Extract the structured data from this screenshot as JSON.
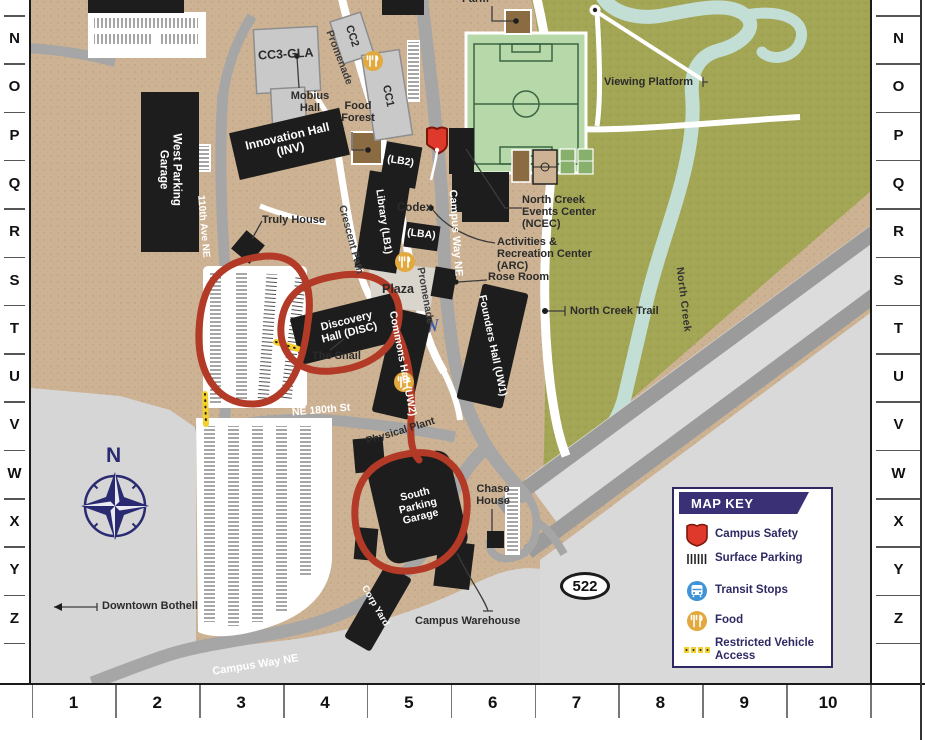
{
  "grid": {
    "rows": [
      "M",
      "N",
      "O",
      "P",
      "Q",
      "R",
      "S",
      "T",
      "U",
      "V",
      "W",
      "X",
      "Y",
      "Z"
    ],
    "cols": [
      "1",
      "2",
      "3",
      "4",
      "5",
      "6",
      "7",
      "8",
      "9",
      "10"
    ]
  },
  "buildings": {
    "west_parking_garage": "West Parking Garage",
    "innovation_hall": "Innovation Hall (INV)",
    "cc3_gla": "CC3-GLA",
    "mobius_hall": "Mobius Hall",
    "cc2": "CC2",
    "cc1": "CC1",
    "lb2": "(LB2)",
    "library": "Library (LB1)",
    "lba": "(LBA)",
    "codex": "Codex",
    "truly_house": "Truly House",
    "discovery_hall": "Discovery Hall (DISC)",
    "the_snail": "The Snail",
    "commons_hall": "Commons Hall (UW2)",
    "founders_hall": "Founders Hall (UW1)",
    "plaza": "Plaza",
    "rose_room": "Rose Room",
    "ncec": "North Creek Events Center (NCEC)",
    "arc": "Activities & Recreation Center (ARC)",
    "south_parking_garage": "South Parking Garage",
    "physical_plant": "Physical Plant",
    "chase_house": "Chase House",
    "corp_yard": "Corp Yard",
    "campus_warehouse": "Campus Warehouse",
    "food_forest": "Food Forest",
    "farm": "Farm"
  },
  "roads": {
    "campus_way_ne": "Campus Way NE",
    "promenade": "Promenade",
    "crescent_path": "Crescent Path",
    "ave_110th": "110th Ave NE",
    "ne_180th_st": "NE 180th St",
    "hwy_522": "522"
  },
  "landmarks": {
    "viewing_platform": "Viewing Platform",
    "north_creek_trail": "North Creek Trail",
    "north_creek": "North Creek",
    "downtown_bothell": "Downtown Bothell",
    "compass_north": "N",
    "w_sculpture": "W"
  },
  "map_key": {
    "title": "MAP KEY",
    "items": [
      {
        "icon": "campus-safety-icon",
        "label": "Campus Safety"
      },
      {
        "icon": "surface-parking-icon",
        "label": "Surface Parking"
      },
      {
        "icon": "transit-stops-icon",
        "label": "Transit Stops"
      },
      {
        "icon": "food-icon",
        "label": "Food"
      },
      {
        "icon": "restricted-vehicle-icon",
        "label": "Restricted Vehicle Access"
      }
    ]
  },
  "colors": {
    "campus_tan": "#cdb394",
    "vegetation_olive": "#a3a655",
    "creek_blue": "#c3ded5",
    "road_gray": "#a6a6a6",
    "outside_gray": "#d6d6d6",
    "building_black": "#1d1d1d",
    "annotation_red": "#b23a27",
    "key_navy": "#2e2963",
    "safety_red": "#df392b",
    "transit_blue": "#3f93d6",
    "food_orange": "#e2a93e",
    "restricted_yellow": "#f4d02c"
  }
}
